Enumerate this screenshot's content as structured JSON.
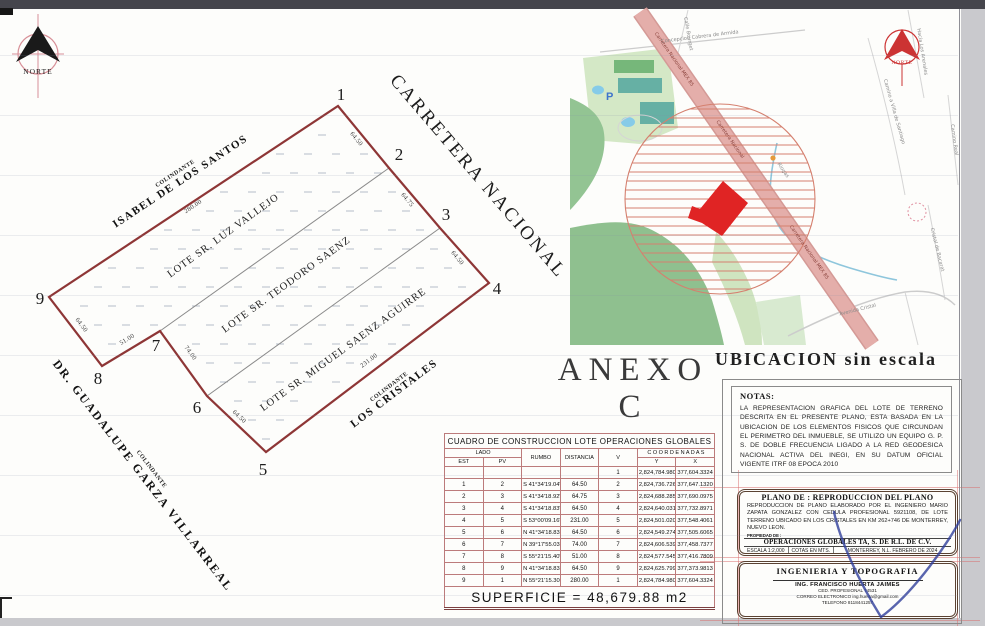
{
  "sheet": {
    "anexo_title": "ANEXO  C"
  },
  "north": {
    "label": "NORTE"
  },
  "plot": {
    "road_label": "CARRETERA NACIONAL",
    "vertices": [
      "1",
      "2",
      "3",
      "4",
      "5",
      "6",
      "7",
      "8",
      "9"
    ],
    "lots": [
      "LOTE SR. LUZ VALLEJO",
      "LOTE SR. TEODORO SAENZ",
      "LOTE SR. MIGUEL SAENZ AGUIRRE"
    ],
    "colindante_label": "COLINDANTE",
    "colindantes": [
      "ISABEL DE LOS SANTOS",
      "DR. GUADALUPE GARZA VILLARREAL",
      "LOS CRISTALES"
    ],
    "measures": {
      "m91": "280.00",
      "m12": "64.50",
      "m23": "64.75",
      "m34": "64.50",
      "m45": "231.00",
      "m56": "64.50",
      "m67": "74.00",
      "m78": "51.00",
      "m89": "64.50"
    }
  },
  "map": {
    "caption": "UBICACION  sin  escala",
    "north_label": "NORTE",
    "roads": {
      "r1": "Carretera Nacional MEX 85",
      "r2": "Carretera Nacional",
      "r3": "Carretera Nacional MEX 85"
    },
    "streets": {
      "concepcion": "Concepcion Cabrera de Armida",
      "bourget": "Calle Bourget",
      "villa": "Camino a Villa de Santiago",
      "arenales": "Hacia Los Arenales",
      "camino_real": "Camino Real",
      "cristal_bacarat": "Cristal de Bacarat",
      "avenida": "Avenida Cristal",
      "riogas": "Riogas",
      "parking": "P"
    }
  },
  "notas": {
    "title": "NOTAS:",
    "body": "LA REPRESENTACION GRAFICA DEL LOTE DE TERRENO DESCRITA EN EL PRESENTE PLANO, ESTA BASADA EN LA UBICACION DE LOS ELEMENTOS FISICOS QUE CIRCUNDAN EL PERIMETRO DEL INMUEBLE, SE UTILIZO UN EQUIPO G. P. S. DE DOBLE FRECUENCIA LIGADO A LA RED GEODESICA NACIONAL ACTIVA DEL INEGI, EN SU DATUM OFICIAL VIGENTE ITRF 08 EPOCA 2010"
  },
  "table": {
    "title": "CUADRO DE CONSTRUCCION LOTE OPERACIONES GLOBALES",
    "headers": {
      "lado": "LADO",
      "est": "EST",
      "pv": "PV",
      "rumbo": "RUMBO",
      "distancia": "DISTANCIA",
      "v": "V",
      "coordenadas": "C O O R D E N A D A S",
      "y": "Y",
      "x": "X"
    },
    "rows": [
      {
        "est": "",
        "pv": "",
        "rumbo": "",
        "dist": "",
        "v": "1",
        "y": "2,824,784.9800",
        "x": "377,604.3324"
      },
      {
        "est": "1",
        "pv": "2",
        "rumbo": "S 41°34'19.04\" E",
        "dist": "64.50",
        "v": "2",
        "y": "2,824,736.7261",
        "x": "377,647.1320"
      },
      {
        "est": "2",
        "pv": "3",
        "rumbo": "S 41°34'18.92\" E",
        "dist": "64.75",
        "v": "3",
        "y": "2,824,688.2851",
        "x": "377,690.0975"
      },
      {
        "est": "3",
        "pv": "4",
        "rumbo": "S 41°34'18.83\" E",
        "dist": "64.50",
        "v": "4",
        "y": "2,824,640.0311",
        "x": "377,732.8971"
      },
      {
        "est": "4",
        "pv": "5",
        "rumbo": "S 53°00'09.16\" W",
        "dist": "231.00",
        "v": "5",
        "y": "2,824,501.0200",
        "x": "377,548.4061"
      },
      {
        "est": "5",
        "pv": "6",
        "rumbo": "N 41°34'18.83\" W",
        "dist": "64.50",
        "v": "6",
        "y": "2,824,549.2740",
        "x": "377,505.6065"
      },
      {
        "est": "6",
        "pv": "7",
        "rumbo": "N 39°17'55.03\" W",
        "dist": "74.00",
        "v": "7",
        "y": "2,824,606.5393",
        "x": "377,458.7377"
      },
      {
        "est": "7",
        "pv": "8",
        "rumbo": "S 55°21'15.40\" W",
        "dist": "51.00",
        "v": "8",
        "y": "2,824,577.5458",
        "x": "377,416.7809"
      },
      {
        "est": "8",
        "pv": "9",
        "rumbo": "N 41°34'18.83\" W",
        "dist": "64.50",
        "v": "9",
        "y": "2,824,625.7998",
        "x": "377,373.9813"
      },
      {
        "est": "9",
        "pv": "1",
        "rumbo": "N 55°21'15.30\" E",
        "dist": "280.00",
        "v": "1",
        "y": "2,824,784.9800",
        "x": "377,604.3324"
      }
    ],
    "superficie": "SUPERFICIE  =  48,679.88  m2"
  },
  "plano_block": {
    "title": "PLANO DE : REPRODUCCION DEL PLANO",
    "body": "REPRODUCCION DE PLANO ELABORADO POR EL INGENIERO MARIO ZAPATA GONZALEZ CON CEDULA PROFESIONAL 5921108, DE LOTE TERRENO UBICADO EN LOS CRISTALES EN KM 262+746 DE MONTERREY, NUEVO LEON.",
    "propiedad": "PROPIEDAD DE :",
    "owner": "OPERACIONES GLOBALES TA, S. DE R.L. DE C.V.",
    "escala": "ESCALA 1:2,000",
    "cotas": "COTAS EN MTS.",
    "lugar": "MONTERREY, N.L.   FEBRERO DE 2024"
  },
  "firma_block": {
    "title": "INGENIERIA Y TOPOGRAFIA",
    "ing": "ING. FRANCISCO HUERTA JAIMES",
    "cedula": "CED. PROFESIONAL 74531",
    "correo": "CORREO ELECTRONICO ing.huerta@gmail.com",
    "telefono": "TELEFONO 8118441257"
  }
}
